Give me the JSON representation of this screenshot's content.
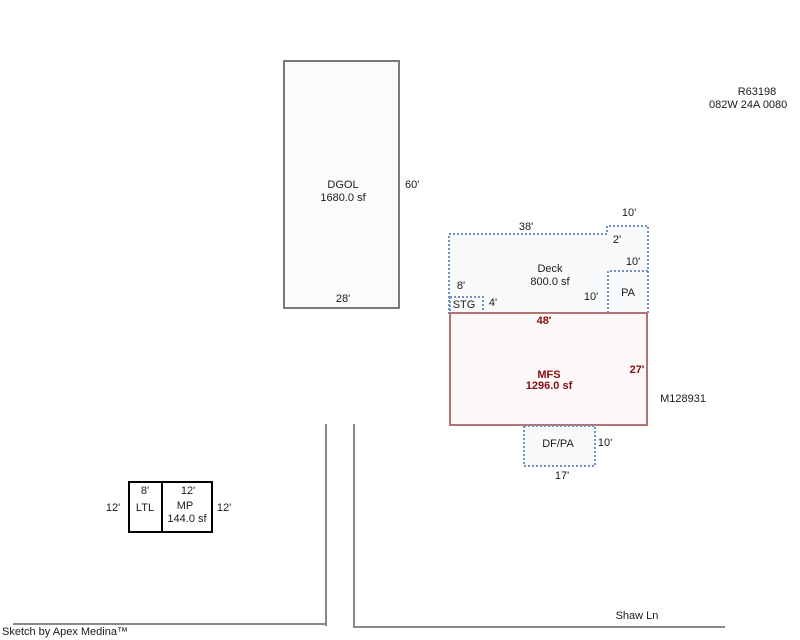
{
  "colors": {
    "deck_outline": "#7191c2",
    "deck_fill": "#f8fafc",
    "mfs_outline": "#b17373",
    "mfs_fill": "#fcf8f9",
    "mfs_text": "#860d0d",
    "structure_outline": "#7a7a7a",
    "structure_fill": "#fbfbfb",
    "outbuilding_outline": "#000000",
    "road": "#8a8a8a",
    "text": "#1a1a1a"
  },
  "header": {
    "record_number": "R63198",
    "parcel_number": "082W 24A 0080"
  },
  "sketch": {
    "dgol": {
      "name": "DGOL",
      "area": "1680.0 sf",
      "right_dim": "60'",
      "bottom_dim": "28'"
    },
    "deck": {
      "name": "Deck",
      "area": "800.0 sf",
      "top_dim": "38'",
      "notch_top_dim": "10'",
      "notch_right_dim": "2'"
    },
    "pa": {
      "name": "PA",
      "top_dim": "10'",
      "left_dim": "10'"
    },
    "stg": {
      "name": "STG",
      "top_dim": "8'",
      "right_dim": "4'"
    },
    "mfs": {
      "name": "MFS",
      "area": "1296.0 sf",
      "top_dim": "48'",
      "right_dim": "27'",
      "tag": "M128931"
    },
    "dfpa": {
      "name": "DF/PA",
      "right_dim": "10'",
      "bottom_dim": "17'"
    },
    "ltl": {
      "name": "LTL",
      "top_dim": "8'",
      "left_dim": "12'"
    },
    "mp": {
      "name": "MP",
      "area": "144.0 sf",
      "top_dim": "12'",
      "right_dim": "12'"
    }
  },
  "road": {
    "name": "Shaw Ln"
  },
  "footer": {
    "credit": "Sketch by Apex Medina™"
  }
}
